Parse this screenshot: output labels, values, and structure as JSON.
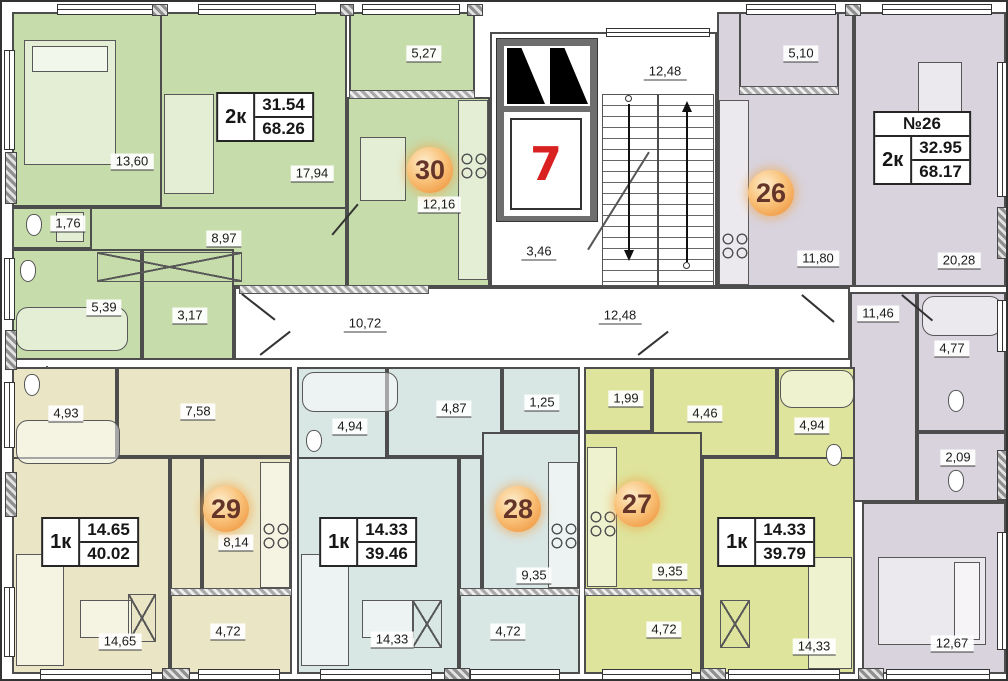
{
  "apartments": {
    "a30": {
      "badge": "30",
      "type": "2к",
      "area_room": "31.54",
      "area_total": "68.26",
      "dims": {
        "bedroom": "13,60",
        "living": "17,94",
        "balcony": "5,27",
        "kitchen": "12,16",
        "hall": "8,97",
        "wc": "1,76",
        "bath": "5,39",
        "entry": "3,17"
      }
    },
    "a26": {
      "badge": "26",
      "number": "№26",
      "type": "2к",
      "area_room": "32.95",
      "area_total": "68.17",
      "dims": {
        "balcony": "5,10",
        "kitchen": "11,80",
        "living": "20,28",
        "hall": "11,46",
        "bath": "4,77",
        "wc": "2,09",
        "bedroom": "12,67"
      }
    },
    "a29": {
      "badge": "29",
      "type": "1к",
      "area_room": "14.65",
      "area_total": "40.02",
      "dims": {
        "bath": "4,93",
        "hall": "7,58",
        "kitchen": "8,14",
        "living": "14,65",
        "balcony": "4,72"
      }
    },
    "a28": {
      "badge": "28",
      "type": "1к",
      "area_room": "14.33",
      "area_total": "39.46",
      "dims": {
        "bath": "4,94",
        "hall": "4,87",
        "closet": "1,25",
        "kitchen": "9,35",
        "living": "14,33",
        "balcony": "4,72"
      }
    },
    "a27": {
      "badge": "27",
      "type": "1к",
      "area_room": "14.33",
      "area_total": "39.79",
      "dims": {
        "closet": "1,99",
        "hall": "4,46",
        "bath": "4,94",
        "kitchen": "9,35",
        "living": "14,33",
        "balcony": "4,72"
      }
    }
  },
  "common": {
    "elevator_number": "7",
    "lobby": "3,46",
    "stairs": "12,48",
    "corridor_left": "10,72",
    "corridor_right": "12,48"
  },
  "colors": {
    "apt30": "#c6dcab",
    "apt26": "#d8d3dd",
    "apt29": "#eae6c5",
    "apt28": "#d8e6e4",
    "apt27": "#dee49c",
    "badge": "#f2a14e",
    "badge_text": "#66352a",
    "elevator_red": "#d92121"
  }
}
